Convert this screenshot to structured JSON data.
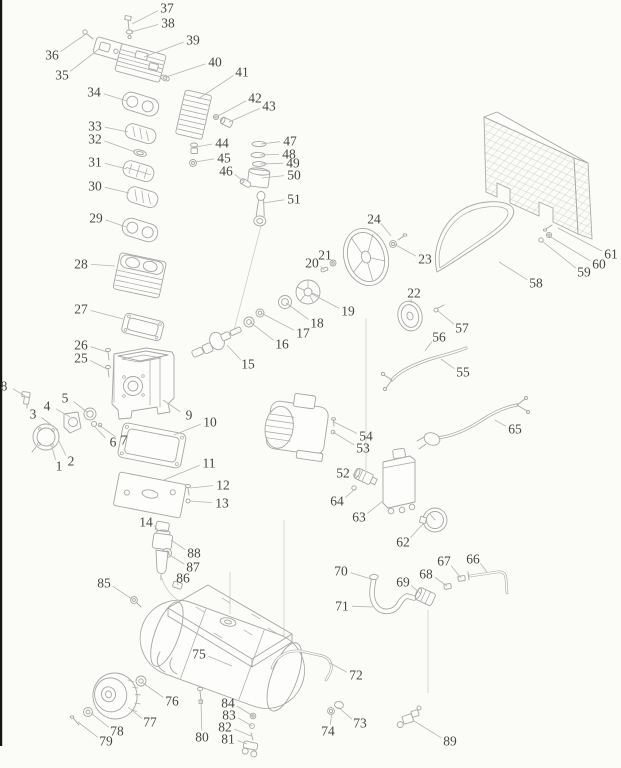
{
  "style": {
    "paper_color": "#fbfbf8",
    "line_color": "#a6a6a6",
    "label_ink_color": "#474747",
    "leader_line_color": "#b4b4b4",
    "left_edge_bar_color": "#151515"
  },
  "diagram": {
    "labels": [
      {
        "n": "1",
        "x": 59,
        "y": 466,
        "tx": 52,
        "ty": 447
      },
      {
        "n": "2",
        "x": 71,
        "y": 461,
        "tx": 59,
        "ty": 441
      },
      {
        "n": "3",
        "x": 33,
        "y": 414,
        "tx": 58,
        "ty": 430
      },
      {
        "n": "4",
        "x": 47,
        "y": 406,
        "tx": 70,
        "ty": 417
      },
      {
        "n": "5",
        "x": 65,
        "y": 398,
        "tx": 87,
        "ty": 412
      },
      {
        "n": "6",
        "x": 113,
        "y": 442,
        "tx": 94,
        "ty": 426
      },
      {
        "n": "7",
        "x": 124,
        "y": 440,
        "tx": 99,
        "ty": 425
      },
      {
        "n": "8",
        "x": 4,
        "y": 386,
        "tx": 25,
        "ty": 396
      },
      {
        "n": "9",
        "x": 189,
        "y": 415,
        "tx": 163,
        "ty": 400
      },
      {
        "n": "10",
        "x": 210,
        "y": 422,
        "tx": 174,
        "ty": 435
      },
      {
        "n": "11",
        "x": 209,
        "y": 463,
        "tx": 164,
        "ty": 480
      },
      {
        "n": "12",
        "x": 223,
        "y": 485,
        "tx": 190,
        "ty": 488
      },
      {
        "n": "13",
        "x": 222,
        "y": 503,
        "tx": 190,
        "ty": 501
      },
      {
        "n": "14",
        "x": 146,
        "y": 522,
        "tx": 158,
        "ty": 530
      },
      {
        "n": "15",
        "x": 248,
        "y": 364,
        "tx": 227,
        "ty": 345
      },
      {
        "n": "16",
        "x": 282,
        "y": 344,
        "tx": 250,
        "ty": 322
      },
      {
        "n": "17",
        "x": 303,
        "y": 333,
        "tx": 261,
        "ty": 313
      },
      {
        "n": "18",
        "x": 317,
        "y": 323,
        "tx": 286,
        "ty": 303
      },
      {
        "n": "19",
        "x": 348,
        "y": 311,
        "tx": 312,
        "ty": 294
      },
      {
        "n": "20",
        "x": 312,
        "y": 263,
        "tx": 324,
        "ty": 270
      },
      {
        "n": "21",
        "x": 325,
        "y": 255,
        "tx": 333,
        "ty": 263
      },
      {
        "n": "22",
        "x": 414,
        "y": 293,
        "tx": 411,
        "ty": 303
      },
      {
        "n": "23",
        "x": 425,
        "y": 259,
        "tx": 394,
        "ty": 244
      },
      {
        "n": "24",
        "x": 374,
        "y": 219,
        "tx": 391,
        "ty": 236
      },
      {
        "n": "25",
        "x": 81,
        "y": 358,
        "tx": 107,
        "ty": 369
      },
      {
        "n": "26",
        "x": 81,
        "y": 345,
        "tx": 107,
        "ty": 352
      },
      {
        "n": "27",
        "x": 81,
        "y": 309,
        "tx": 123,
        "ty": 319
      },
      {
        "n": "28",
        "x": 81,
        "y": 264,
        "tx": 115,
        "ty": 266
      },
      {
        "n": "29",
        "x": 96,
        "y": 218,
        "tx": 126,
        "ty": 227
      },
      {
        "n": "30",
        "x": 95,
        "y": 186,
        "tx": 129,
        "ty": 193
      },
      {
        "n": "31",
        "x": 95,
        "y": 162,
        "tx": 127,
        "ty": 169
      },
      {
        "n": "32",
        "x": 95,
        "y": 139,
        "tx": 135,
        "ty": 152
      },
      {
        "n": "33",
        "x": 95,
        "y": 126,
        "tx": 128,
        "ty": 132
      },
      {
        "n": "34",
        "x": 94,
        "y": 92,
        "tx": 127,
        "ty": 101
      },
      {
        "n": "35",
        "x": 62,
        "y": 75,
        "tx": 99,
        "ty": 49
      },
      {
        "n": "36",
        "x": 52,
        "y": 55,
        "tx": 86,
        "ty": 34
      },
      {
        "n": "37",
        "x": 167,
        "y": 8,
        "tx": 132,
        "ty": 24
      },
      {
        "n": "38",
        "x": 168,
        "y": 23,
        "tx": 131,
        "ty": 32
      },
      {
        "n": "39",
        "x": 193,
        "y": 40,
        "tx": 144,
        "ty": 57
      },
      {
        "n": "40",
        "x": 215,
        "y": 62,
        "tx": 166,
        "ty": 77
      },
      {
        "n": "41",
        "x": 242,
        "y": 72,
        "tx": 198,
        "ty": 99
      },
      {
        "n": "42",
        "x": 255,
        "y": 98,
        "tx": 218,
        "ty": 116
      },
      {
        "n": "43",
        "x": 269,
        "y": 106,
        "tx": 229,
        "ty": 122
      },
      {
        "n": "44",
        "x": 222,
        "y": 143,
        "tx": 196,
        "ty": 147
      },
      {
        "n": "45",
        "x": 224,
        "y": 158,
        "tx": 195,
        "ty": 162
      },
      {
        "n": "46",
        "x": 226,
        "y": 171,
        "tx": 243,
        "ty": 181
      },
      {
        "n": "47",
        "x": 290,
        "y": 141,
        "tx": 261,
        "ty": 144
      },
      {
        "n": "48",
        "x": 289,
        "y": 154,
        "tx": 260,
        "ty": 155
      },
      {
        "n": "49",
        "x": 293,
        "y": 163,
        "tx": 260,
        "ty": 164
      },
      {
        "n": "50",
        "x": 294,
        "y": 175,
        "tx": 262,
        "ty": 178
      },
      {
        "n": "51",
        "x": 294,
        "y": 199,
        "tx": 263,
        "ty": 203
      },
      {
        "n": "52",
        "x": 343,
        "y": 473,
        "tx": 359,
        "ty": 477
      },
      {
        "n": "53",
        "x": 363,
        "y": 448,
        "tx": 333,
        "ty": 432
      },
      {
        "n": "54",
        "x": 366,
        "y": 436,
        "tx": 334,
        "ty": 422
      },
      {
        "n": "55",
        "x": 463,
        "y": 372,
        "tx": 441,
        "ty": 359
      },
      {
        "n": "56",
        "x": 439,
        "y": 337,
        "tx": 425,
        "ty": 351
      },
      {
        "n": "57",
        "x": 462,
        "y": 328,
        "tx": 437,
        "ty": 310
      },
      {
        "n": "58",
        "x": 536,
        "y": 283,
        "tx": 499,
        "ty": 262
      },
      {
        "n": "59",
        "x": 584,
        "y": 272,
        "tx": 542,
        "ty": 241
      },
      {
        "n": "60",
        "x": 599,
        "y": 264,
        "tx": 549,
        "ty": 236
      },
      {
        "n": "61",
        "x": 611,
        "y": 254,
        "tx": 558,
        "ty": 228
      },
      {
        "n": "62",
        "x": 403,
        "y": 542,
        "tx": 424,
        "ty": 523
      },
      {
        "n": "63",
        "x": 359,
        "y": 517,
        "tx": 383,
        "ty": 501
      },
      {
        "n": "64",
        "x": 337,
        "y": 501,
        "tx": 355,
        "ty": 489
      },
      {
        "n": "65",
        "x": 515,
        "y": 429,
        "tx": 495,
        "ty": 420
      },
      {
        "n": "66",
        "x": 473,
        "y": 559,
        "tx": 487,
        "ty": 572
      },
      {
        "n": "67",
        "x": 444,
        "y": 561,
        "tx": 461,
        "ty": 578
      },
      {
        "n": "68",
        "x": 426,
        "y": 574,
        "tx": 447,
        "ty": 586
      },
      {
        "n": "69",
        "x": 403,
        "y": 582,
        "tx": 421,
        "ty": 594
      },
      {
        "n": "70",
        "x": 341,
        "y": 571,
        "tx": 371,
        "ty": 579
      },
      {
        "n": "71",
        "x": 342,
        "y": 606,
        "tx": 373,
        "ty": 607
      },
      {
        "n": "72",
        "x": 356,
        "y": 675,
        "tx": 330,
        "ty": 663
      },
      {
        "n": "73",
        "x": 360,
        "y": 723,
        "tx": 338,
        "ty": 707
      },
      {
        "n": "74",
        "x": 328,
        "y": 731,
        "tx": 332,
        "ty": 713
      },
      {
        "n": "75",
        "x": 199,
        "y": 654,
        "tx": 232,
        "ty": 666
      },
      {
        "n": "76",
        "x": 172,
        "y": 701,
        "tx": 143,
        "ty": 683
      },
      {
        "n": "77",
        "x": 150,
        "y": 722,
        "tx": 128,
        "ty": 707
      },
      {
        "n": "78",
        "x": 117,
        "y": 731,
        "tx": 91,
        "ty": 713
      },
      {
        "n": "79",
        "x": 106,
        "y": 741,
        "tx": 78,
        "ty": 722
      },
      {
        "n": "80",
        "x": 202,
        "y": 737,
        "tx": 201,
        "ty": 700
      },
      {
        "n": "81",
        "x": 228,
        "y": 739,
        "tx": 247,
        "ty": 744
      },
      {
        "n": "82",
        "x": 225,
        "y": 727,
        "tx": 251,
        "ty": 736
      },
      {
        "n": "83",
        "x": 229,
        "y": 715,
        "tx": 252,
        "ty": 726
      },
      {
        "n": "84",
        "x": 228,
        "y": 703,
        "tx": 253,
        "ty": 716
      },
      {
        "n": "85",
        "x": 104,
        "y": 583,
        "tx": 132,
        "ty": 599
      },
      {
        "n": "86",
        "x": 183,
        "y": 578,
        "tx": 178,
        "ty": 585
      },
      {
        "n": "87",
        "x": 193,
        "y": 567,
        "tx": 168,
        "ty": 554
      },
      {
        "n": "88",
        "x": 194,
        "y": 553,
        "tx": 171,
        "ty": 540
      },
      {
        "n": "89",
        "x": 450,
        "y": 741,
        "tx": 414,
        "ty": 721
      }
    ]
  }
}
